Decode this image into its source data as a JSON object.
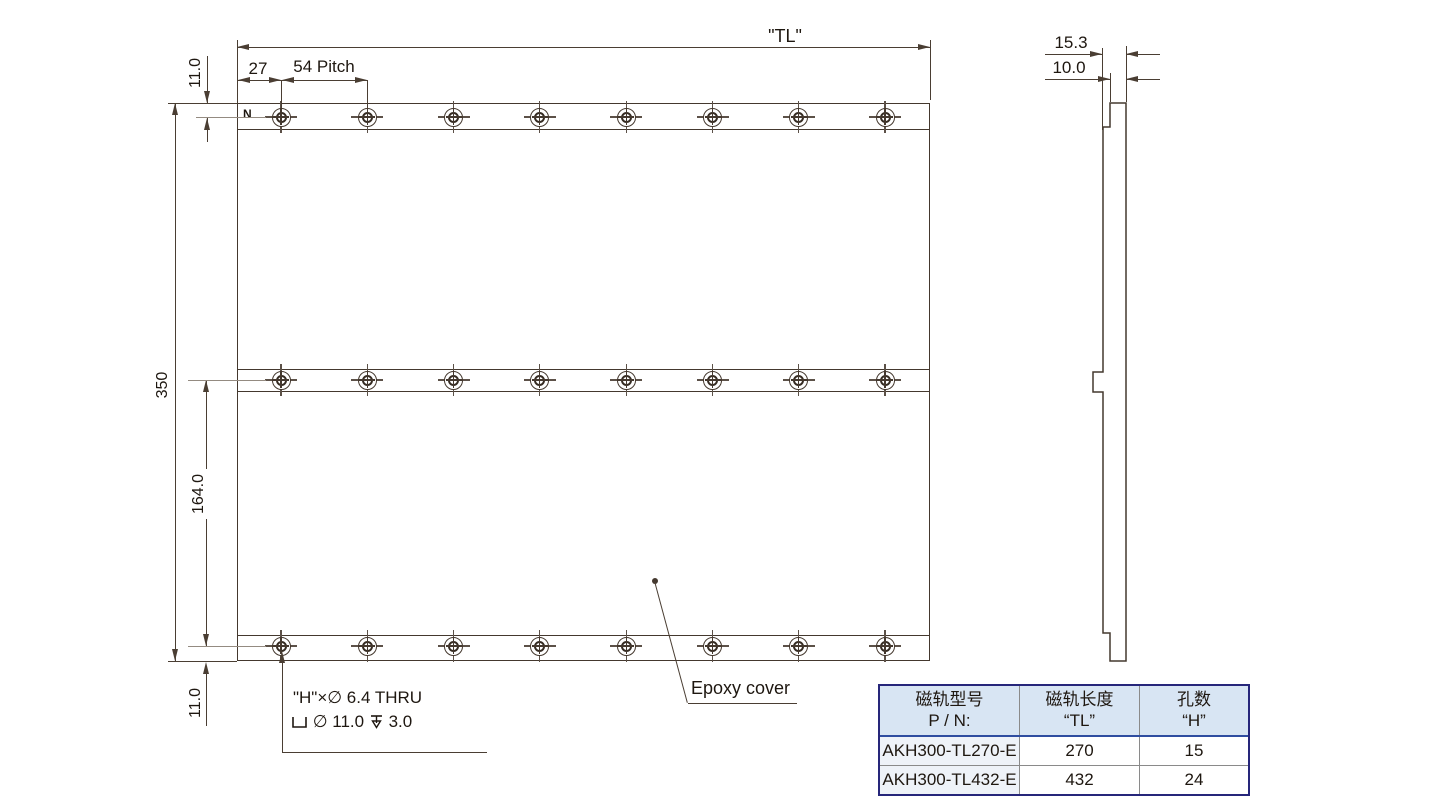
{
  "drawing": {
    "front_view": {
      "dim_total_length": "\"TL\"",
      "dim_edge_to_hole": "27",
      "dim_pitch": "54 Pitch",
      "dim_top_margin": "11.0",
      "dim_height": "350",
      "dim_row_spacing": "164.0",
      "dim_bottom_margin": "11.0",
      "pole_label": "N",
      "epoxy_label": "Epoxy cover",
      "hole_note_line1": "\"H\"×∅ 6.4 THRU",
      "hole_note_cbore_dia": "∅ 11.0",
      "hole_note_depth": "3.0",
      "rows": 3,
      "holes_per_row": 8
    },
    "side_view": {
      "dim_total_thickness": "15.3",
      "dim_body_thickness": "10.0"
    }
  },
  "table": {
    "headers": [
      {
        "line1": "磁轨型号",
        "line2": "P / N:"
      },
      {
        "line1": "磁轨长度",
        "line2": "“TL”"
      },
      {
        "line1": "孔数",
        "line2": "“H”"
      }
    ],
    "rows": [
      {
        "pn": "AKH300-TL270-E",
        "tl": "270",
        "h": "15"
      },
      {
        "pn": "AKH300-TL432-E",
        "tl": "432",
        "h": "24"
      }
    ]
  },
  "colors": {
    "line": "#44382e",
    "table_border": "#26267a",
    "table_header_bg": "#d8e5f3",
    "table_pn_bg": "#eef2f8"
  }
}
